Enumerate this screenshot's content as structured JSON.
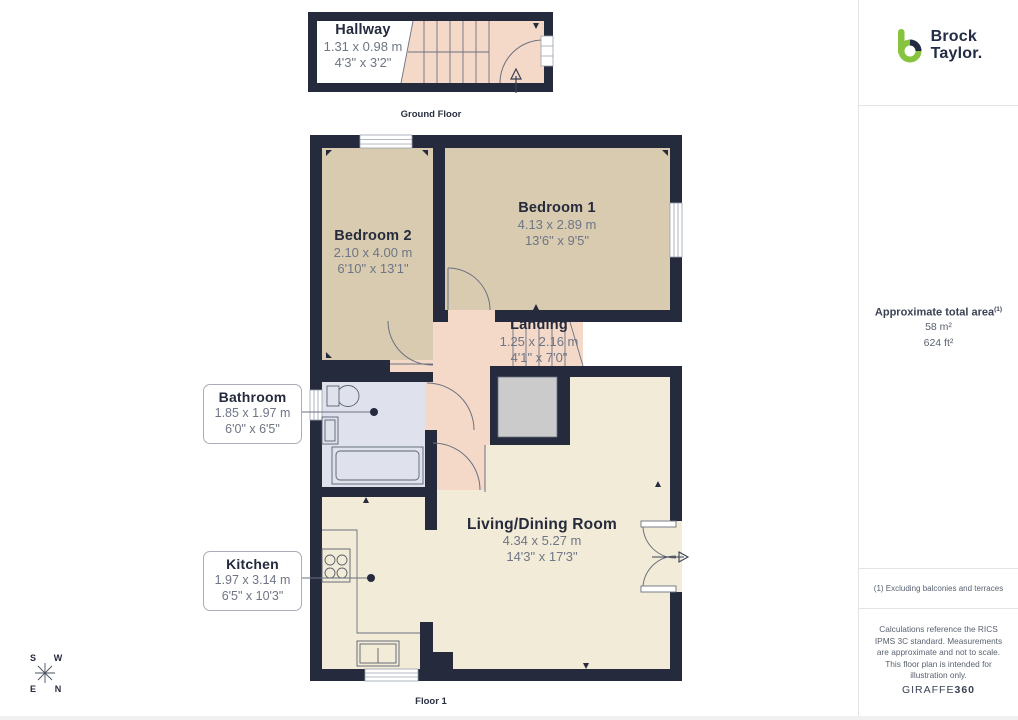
{
  "ground_floor": {
    "floor_label": "Ground Floor",
    "hallway": {
      "name": "Hallway",
      "metric": "1.31 x 0.98 m",
      "imperial": "4'3\" x 3'2\""
    }
  },
  "floor_1": {
    "floor_label": "Floor 1",
    "bedroom_1": {
      "name": "Bedroom 1",
      "metric": "4.13 x 2.89 m",
      "imperial": "13'6\" x 9'5\""
    },
    "bedroom_2": {
      "name": "Bedroom 2",
      "metric": "2.10 x 4.00 m",
      "imperial": "6'10\" x 13'1\""
    },
    "landing": {
      "name": "Landing",
      "metric": "1.25 x 2.16 m",
      "imperial": "4'1\" x 7'0\""
    },
    "living_dining": {
      "name": "Living/Dining Room",
      "metric": "4.34 x 5.27 m",
      "imperial": "14'3\" x 17'3\""
    },
    "bathroom": {
      "name": "Bathroom",
      "metric": "1.85 x 1.97 m",
      "imperial": "6'0\" x 6'5\""
    },
    "kitchen": {
      "name": "Kitchen",
      "metric": "1.97 x 3.14 m",
      "imperial": "6'5\" x 10'3\""
    }
  },
  "compass": {
    "n": "N",
    "e": "E",
    "s": "S",
    "w": "W"
  },
  "sidebar": {
    "brand_line1": "Brock",
    "brand_line2": "Taylor.",
    "area_title": "Approximate total area",
    "area_footnote_ref": "(1)",
    "area_metric": "58 m²",
    "area_imperial": "624 ft²",
    "footnote": "(1) Excluding balconies and terraces",
    "disclaimer": "Calculations reference the RICS IPMS 3C standard. Measurements are approximate and not to scale. This floor plan is intended for illustration only.",
    "credit_name": "GIRAFFE",
    "credit_bold": "360"
  },
  "colors": {
    "wall": "#252b3c",
    "bedroom_fill": "#d8cbb0",
    "living_fill": "#f2ebd7",
    "landing_fill": "#f5d9c8",
    "bathroom_fill": "#dfe2ed",
    "storage_fill": "#cbcbcb",
    "brand_green": "#86c440",
    "brand_navy": "#232b45"
  }
}
